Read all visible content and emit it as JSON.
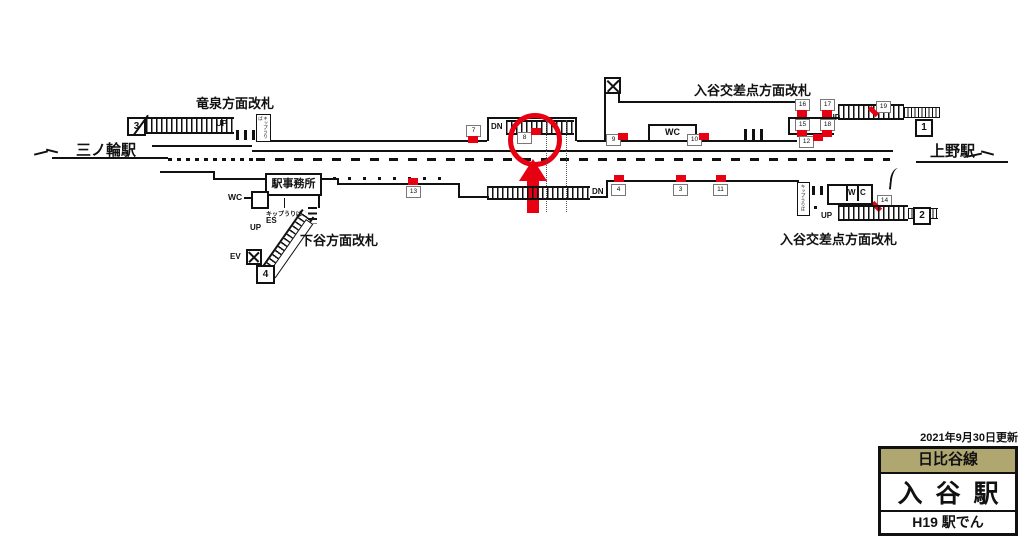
{
  "stations": {
    "left": "三ノ輪駅",
    "right": "上野駅"
  },
  "gates": {
    "ryusen": "竜泉方面改札",
    "iriya_top": "入谷交差点方面改札",
    "shitaya": "下谷方面改札",
    "iriya_bottom": "入谷交差点方面改札"
  },
  "exits": {
    "e1": "1",
    "e2": "2",
    "e3": "3",
    "e4": "4"
  },
  "facilities": {
    "office": "駅事務所",
    "wc": "WC",
    "w": "W",
    "c": "C",
    "ticket": "キップうりば"
  },
  "movement": {
    "up": "UP",
    "dn": "DN",
    "es": "ES",
    "ev": "EV"
  },
  "ads": {
    "a3": "3",
    "a4": "4",
    "a7": "7",
    "a8": "8",
    "a9": "9",
    "a10": "10",
    "a11": "11",
    "a12": "12",
    "a13": "13",
    "a14": "14",
    "a15": "15",
    "a16": "16",
    "a17": "17",
    "a18": "18",
    "a19": "19"
  },
  "highlight": {
    "circled": "8"
  },
  "panel": {
    "updated": "2021年9月30日更新",
    "line": "日比谷線",
    "station": "入谷駅",
    "code": "H19 駅でん"
  },
  "colors": {
    "red": "#e60012",
    "line_badge": "#b0a670",
    "ink": "#111111"
  }
}
